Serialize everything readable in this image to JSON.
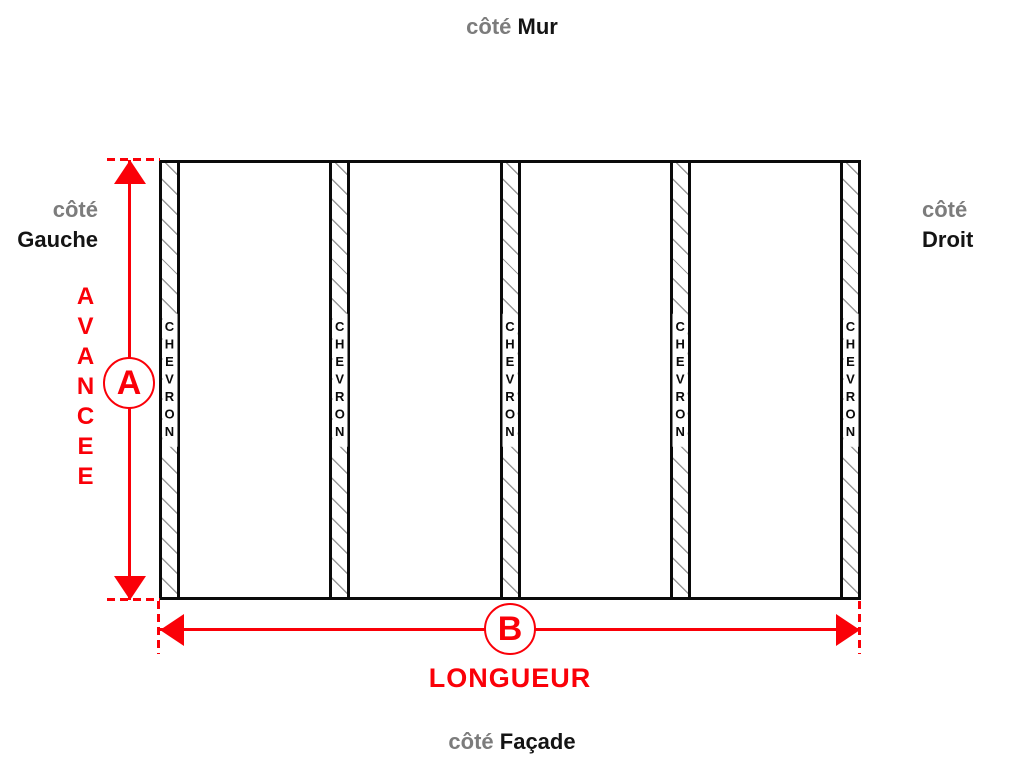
{
  "colors": {
    "accent_red": "#fa0008",
    "label_gray": "#7c7c7c",
    "label_black": "#141414",
    "hatch_gray": "#999999"
  },
  "sides": {
    "top": {
      "prefix": "côté",
      "name": "Mur"
    },
    "left": {
      "prefix": "côté",
      "name": "Gauche"
    },
    "right": {
      "prefix": "côté",
      "name": "Droit"
    },
    "bottom": {
      "prefix": "côté",
      "name": "Façade"
    }
  },
  "dimensions": {
    "depth": {
      "symbol": "A",
      "label": "AVANCEE"
    },
    "length": {
      "symbol": "B",
      "label": "LONGUEUR"
    }
  },
  "rafters": {
    "count": 5,
    "label": "CHEVRON"
  }
}
